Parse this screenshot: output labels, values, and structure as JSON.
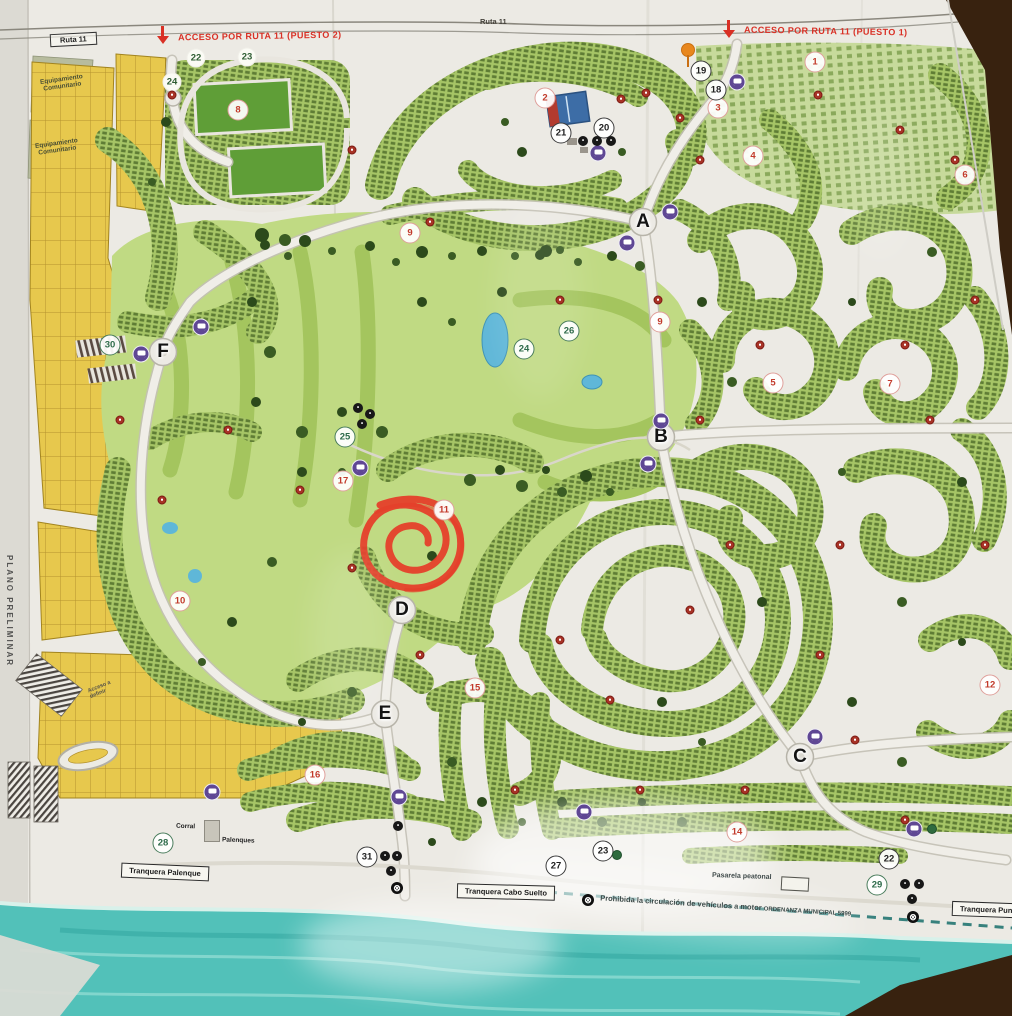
{
  "surface": {
    "table_color": "#3a2417",
    "paper_color": "#eceae4",
    "water_color": "#52c1b9",
    "lot_green": "#a6c566",
    "golf_green": "#c0da83",
    "lot_yellow": "#e7c84d",
    "accent_red": "#d93025",
    "bus_purple": "#5f4794"
  },
  "labels": {
    "ruta11_box": "Ruta 11",
    "ruta11_top": "Ruta 11",
    "acceso_puesto2": "ACCESO POR RUTA 11 (PUESTO 2)",
    "acceso_puesto1": "ACCESO POR RUTA 11 (PUESTO 1)",
    "equipamiento_1": "Equipamiento Comunitario",
    "equipamiento_2": "Equipamiento Comunitario",
    "plano_preliminar": "PLANO PRELIMINAR",
    "acceso_a_definir": "Acceso a definir",
    "corral": "Corral",
    "palenques": "Palenques",
    "tranquera_palenque": "Tranquera Palenque",
    "tranquera_cabo_suelto": "Tranquera Cabo Suelto",
    "tranquera_punta_norte": "Tranquera Punta Nor",
    "pasarela_peatonal": "Pasarela peatonal",
    "beach_rule": "Prohibida la circulación de vehículos a motor",
    "beach_rule_ordinance": "ORDENANZA MUNICIPAL 5999"
  },
  "sectors": [
    {
      "label": "1",
      "x": 815,
      "y": 62,
      "style": "red"
    },
    {
      "label": "2",
      "x": 545,
      "y": 98,
      "style": "red"
    },
    {
      "label": "3",
      "x": 718,
      "y": 108,
      "style": "red"
    },
    {
      "label": "4",
      "x": 753,
      "y": 156,
      "style": "red"
    },
    {
      "label": "5",
      "x": 773,
      "y": 383,
      "style": "red"
    },
    {
      "label": "6",
      "x": 965,
      "y": 175,
      "style": "red"
    },
    {
      "label": "7",
      "x": 890,
      "y": 384,
      "style": "red"
    },
    {
      "label": "8",
      "x": 238,
      "y": 110,
      "style": "red"
    },
    {
      "label": "9",
      "x": 410,
      "y": 233,
      "style": "red"
    },
    {
      "label": "9",
      "x": 660,
      "y": 322,
      "style": "red"
    },
    {
      "label": "10",
      "x": 180,
      "y": 601,
      "style": "red"
    },
    {
      "label": "11",
      "x": 444,
      "y": 510,
      "style": "red"
    },
    {
      "label": "12",
      "x": 990,
      "y": 685,
      "style": "red"
    },
    {
      "label": "14",
      "x": 737,
      "y": 832,
      "style": "red"
    },
    {
      "label": "15",
      "x": 475,
      "y": 688,
      "style": "red"
    },
    {
      "label": "16",
      "x": 315,
      "y": 775,
      "style": "red"
    },
    {
      "label": "17",
      "x": 343,
      "y": 481,
      "style": "red"
    },
    {
      "label": "18",
      "x": 716,
      "y": 90,
      "style": "black"
    },
    {
      "label": "19",
      "x": 701,
      "y": 71,
      "style": "black"
    },
    {
      "label": "20",
      "x": 604,
      "y": 128,
      "style": "black"
    },
    {
      "label": "21",
      "x": 561,
      "y": 133,
      "style": "black"
    },
    {
      "label": "22",
      "x": 889,
      "y": 859,
      "style": "black"
    },
    {
      "label": "23",
      "x": 603,
      "y": 851,
      "style": "black"
    },
    {
      "label": "27",
      "x": 556,
      "y": 866,
      "style": "black"
    },
    {
      "label": "31",
      "x": 367,
      "y": 857,
      "style": "black"
    },
    {
      "label": "24",
      "x": 524,
      "y": 349,
      "style": "green"
    },
    {
      "label": "25",
      "x": 345,
      "y": 437,
      "style": "green"
    },
    {
      "label": "26",
      "x": 569,
      "y": 331,
      "style": "green"
    },
    {
      "label": "28",
      "x": 163,
      "y": 843,
      "style": "green"
    },
    {
      "label": "29",
      "x": 877,
      "y": 885,
      "style": "green"
    },
    {
      "label": "30",
      "x": 110,
      "y": 345,
      "style": "green"
    },
    {
      "label": "22",
      "x": 196,
      "y": 58,
      "style": "wg"
    },
    {
      "label": "23",
      "x": 247,
      "y": 57,
      "style": "wg"
    },
    {
      "label": "24",
      "x": 172,
      "y": 82,
      "style": "wg"
    }
  ],
  "junctions": [
    {
      "label": "A",
      "x": 643,
      "y": 222
    },
    {
      "label": "B",
      "x": 661,
      "y": 437
    },
    {
      "label": "C",
      "x": 800,
      "y": 757
    },
    {
      "label": "D",
      "x": 402,
      "y": 610
    },
    {
      "label": "E",
      "x": 385,
      "y": 714
    },
    {
      "label": "F",
      "x": 163,
      "y": 352
    }
  ],
  "icons": {
    "bus_stop": {
      "icon": "bus-stop-icon",
      "positions": [
        [
          737,
          82
        ],
        [
          598,
          153
        ],
        [
          670,
          212
        ],
        [
          627,
          243
        ],
        [
          141,
          354
        ],
        [
          201,
          327
        ],
        [
          360,
          468
        ],
        [
          661,
          421
        ],
        [
          648,
          464
        ],
        [
          815,
          737
        ],
        [
          914,
          829
        ],
        [
          584,
          812
        ],
        [
          399,
          797
        ],
        [
          212,
          792
        ]
      ]
    },
    "hydrant": {
      "icon": "hydrant-dot-icon",
      "positions": [
        [
          172,
          95
        ],
        [
          352,
          150
        ],
        [
          430,
          222
        ],
        [
          646,
          93
        ],
        [
          621,
          99
        ],
        [
          680,
          118
        ],
        [
          700,
          160
        ],
        [
          560,
          300
        ],
        [
          658,
          300
        ],
        [
          700,
          420
        ],
        [
          760,
          345
        ],
        [
          905,
          345
        ],
        [
          955,
          160
        ],
        [
          900,
          130
        ],
        [
          818,
          95
        ],
        [
          975,
          300
        ],
        [
          930,
          420
        ],
        [
          985,
          545
        ],
        [
          840,
          545
        ],
        [
          730,
          545
        ],
        [
          690,
          610
        ],
        [
          820,
          655
        ],
        [
          855,
          740
        ],
        [
          905,
          820
        ],
        [
          745,
          790
        ],
        [
          640,
          790
        ],
        [
          515,
          790
        ],
        [
          420,
          655
        ],
        [
          352,
          568
        ],
        [
          300,
          490
        ],
        [
          228,
          430
        ],
        [
          162,
          500
        ],
        [
          120,
          420
        ],
        [
          560,
          640
        ],
        [
          610,
          700
        ]
      ]
    },
    "service": {
      "icon": "service-dot-icon",
      "positions": [
        [
          385,
          856
        ],
        [
          397,
          856
        ],
        [
          391,
          871
        ],
        [
          905,
          884
        ],
        [
          919,
          884
        ],
        [
          912,
          899
        ],
        [
          583,
          141
        ],
        [
          597,
          141
        ],
        [
          611,
          141
        ],
        [
          398,
          826
        ],
        [
          358,
          408
        ],
        [
          370,
          414
        ],
        [
          362,
          424
        ]
      ]
    },
    "no_entry": {
      "icon": "no-entry-icon",
      "glyph": "⊗",
      "positions": [
        [
          397,
          888
        ],
        [
          588,
          900
        ],
        [
          913,
          917
        ]
      ]
    },
    "green_dot": {
      "icon": "green-marker-icon",
      "positions": [
        [
          932,
          829
        ],
        [
          617,
          855
        ]
      ]
    },
    "entrance_pin": {
      "icon": "entrance-pin-icon",
      "x": 688,
      "y": 50
    }
  },
  "annotation": {
    "type": "hand-drawn circle marker",
    "color": "#e63c28",
    "x": 408,
    "y": 538
  }
}
